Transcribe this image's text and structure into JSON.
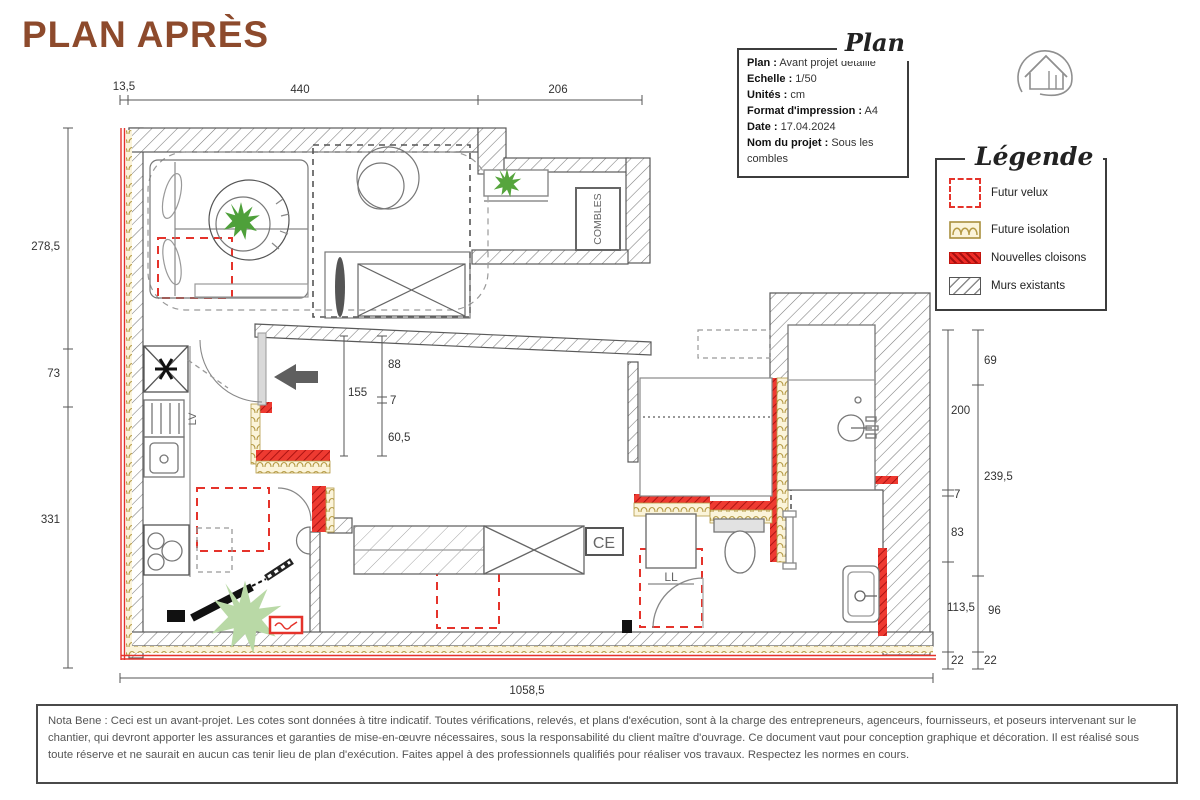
{
  "title": "PLAN APRÈS",
  "colors": {
    "accent": "#8d4a2c",
    "new_partition_red": "#e5332b",
    "isolation_tan": "#b49a45",
    "wall_gray": "#777777",
    "plant_green": "#56a53d",
    "plant_pale_green": "#b9d9a6"
  },
  "info_box": {
    "script_label": "Plan",
    "lines": [
      {
        "label": "Plan :",
        "value": " Avant projet détaillé"
      },
      {
        "label": "Echelle :",
        "value": " 1/50"
      },
      {
        "label": "Unités :",
        "value": " cm"
      },
      {
        "label": "Format d'impression :",
        "value": " A4"
      },
      {
        "label": "Date :",
        "value": " 17.04.2024"
      },
      {
        "label": "Nom du projet :",
        "value": " Sous les combles"
      }
    ]
  },
  "logo": {
    "name": "house-in-circle"
  },
  "legend": {
    "script_label": "Légende",
    "items": [
      {
        "label": "Futur velux",
        "swatch": "red-dashed-square"
      },
      {
        "label": "Future isolation",
        "swatch": "tan-scallop-band"
      },
      {
        "label": "Nouvelles cloisons",
        "swatch": "red-hatched-bar"
      },
      {
        "label": "Murs existants",
        "swatch": "gray-hatched-bar"
      }
    ]
  },
  "dimensions": {
    "top": [
      "13,5",
      "440",
      "206"
    ],
    "left": [
      "278,5",
      "73",
      "331"
    ],
    "right_inner": [
      "200",
      "7",
      "83",
      "113,5",
      "22"
    ],
    "right_outer": [
      "69",
      "239,5",
      "96",
      "22"
    ],
    "bottom": [
      "1058,5"
    ],
    "interior": [
      "88",
      "155",
      "7",
      "60,5"
    ]
  },
  "plan_labels": {
    "dishwasher": "LV",
    "washing_machine": "LL",
    "water_heater": "CE",
    "attic": "COMBLES"
  },
  "nota_bene": "Nota Bene : Ceci est un avant-projet. Les cotes sont données à titre indicatif. Toutes vérifications, relevés, et plans d'exécution, sont à la charge des entrepreneurs, agenceurs, fournisseurs, et poseurs intervenant sur le chantier, qui devront apporter les assurances et garanties de mise-en-œuvre nécessaires, sous la responsabilité du client maître d'ouvrage. Ce document vaut pour conception graphique et décoration. Il est réalisé sous toute réserve et ne saurait en aucun cas tenir lieu de plan d'exécution. Faites appel à des professionnels qualifiés pour réaliser vos travaux. Respectez les normes en cours."
}
